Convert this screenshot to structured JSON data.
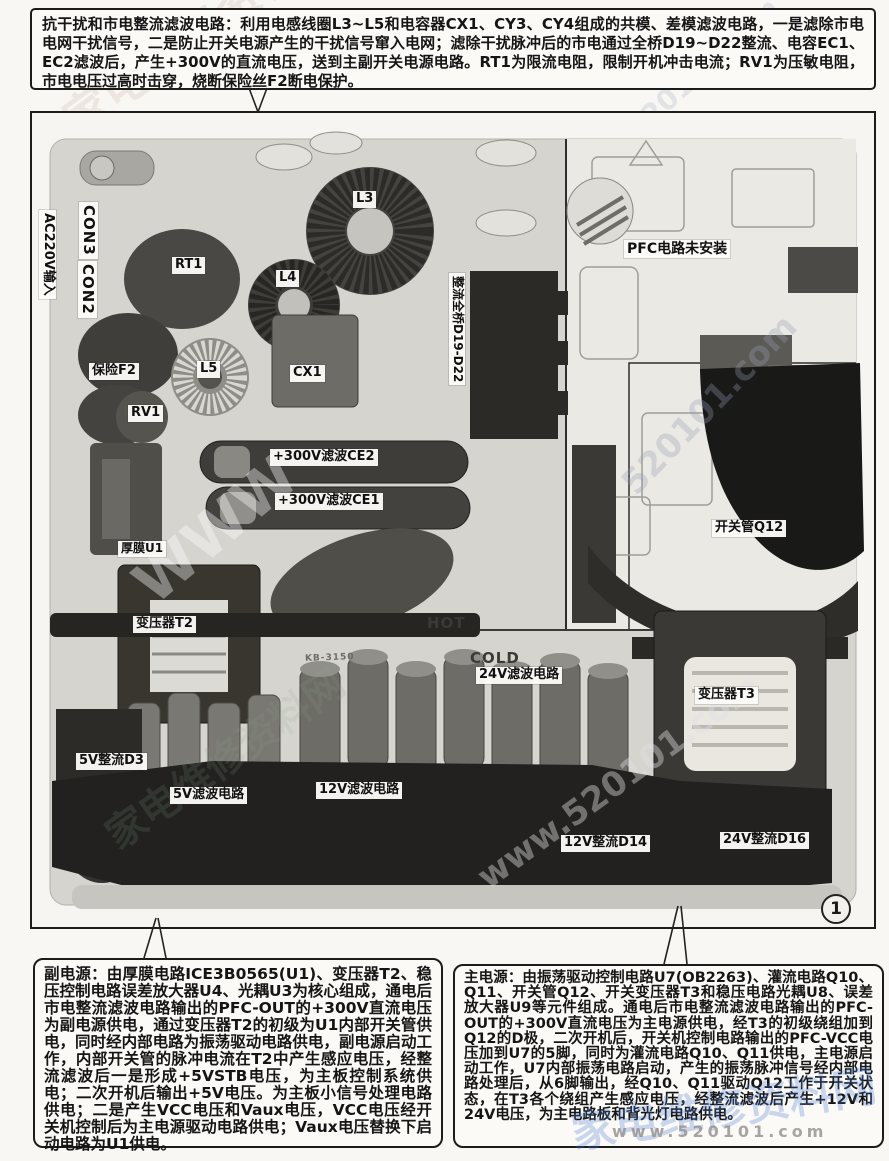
{
  "top_note": {
    "text": "抗干扰和市电整流滤波电路：利用电感线圈L3~L5和电容器CX1、CY3、CY4组成的共模、差模滤波电路，一是滤除市电电网干扰信号，二是防止开关电源产生的干扰信号窜入电网；滤除干扰脉冲后的市电通过全桥D19~D22整流、电容EC1、EC2滤波后，产生+300V的直流电压，送到主副开关电源电路。RT1为限流电阻，限制开机冲击电流；RV1为压敏电阻，市电电压过高时击穿，烧断保险丝F2断电保护。"
  },
  "aux_note": {
    "text": "副电源：由厚膜电路ICE3B0565(U1)、变压器T2、稳压控制电路误差放大器U4、光耦U3为核心组成，通电后市电整流滤波电路输出的PFC-OUT的+300V直流电压为副电源供电，通过变压器T2的初级为U1内部开关管供电，同时经内部电路为振荡驱动电路供电，副电源启动工作，内部开关管的脉冲电流在T2中产生感应电压，经整流滤波后一是形成+5VSTB电压，为主板控制系统供电；二次开机后输出+5V电压。为主板小信号处理电路供电；二是产生VCC电压和Vaux电压，VCC电压经开关机控制后为主电源驱动电路供电；Vaux电压替换下启动电路为U1供电。"
  },
  "main_note": {
    "text": "主电源：由振荡驱动控制电路U7(OB2263)、灌流电路Q10、Q11、开关管Q12、开关变压器T3和稳压电路光耦U8、误差放大器U9等元件组成。通电后市电整流滤波电路输出的PFC-OUT的+300V直流电压为主电源供电，经T3的初级绕组加到Q12的D极，二次开机后，开关机控制电路输出的PFC-VCC电压加到U7的5脚，同时为灌流电路Q10、Q11供电，主电源启动工作，U7内部振荡电路启动，产生的振荡脉冲信号经内部电路处理后，从6脚输出，经Q10、Q11驱动Q12工作于开关状态，在T3各个绕组产生感应电压，经整流滤波后产生+12V和24V电压，为主电路板和背光灯电路供电。"
  },
  "photo_labels": {
    "ac_input": "AC220V输入",
    "con3": "CON3",
    "con2": "CON2",
    "rt1": "RT1",
    "l3": "L3",
    "l4": "L4",
    "l5": "L5",
    "fuse_f2": "保险F2",
    "cx1": "CX1",
    "rv1": "RV1",
    "bridge": "整流全桥D19-D22",
    "pfc_not_installed": "PFC电路未安装",
    "ce2": "+300V滤波CE2",
    "ce1": "+300V滤波CE1",
    "u1": "厚膜U1",
    "t2": "变压器T2",
    "q12": "开关管Q12",
    "hot": "HOT",
    "cold": "COLD",
    "filter_24v": "24V滤波电路",
    "t3": "变压器T3",
    "d3": "5V整流D3",
    "filter_5v": "5V滤波电路",
    "filter_12v": "12V滤波电路",
    "d14": "12V整流D14",
    "d16": "24V整流D16",
    "silkscreen": "KB-3150"
  },
  "figure": {
    "number": "1"
  },
  "watermarks": {
    "url": "www.520101.com",
    "partial": "520101.com",
    "www": "WWW",
    "site_name": "家电维修资料网",
    "colors": {
      "blue": "#4a7ad2",
      "gray": "#a0a09d"
    }
  }
}
